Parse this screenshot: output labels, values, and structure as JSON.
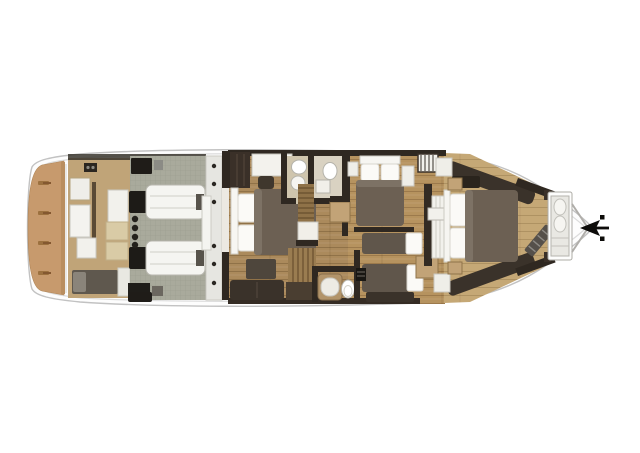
{
  "meta": {
    "plan_type": "yacht-lower-deck-floor-plan",
    "orientation": "bow-right",
    "engine_count": 2,
    "cleat_count": 4,
    "cabin_count": 4
  },
  "palette": {
    "background": "#ffffff",
    "hull_fill": "#fdfdfd",
    "hull_stroke": "#c2c2c2",
    "deck_line": "#dcdcdc",
    "teak": "#c79a6d",
    "teak_edge": "#b98e5f",
    "cleat": "#9c713f",
    "crew_floor": "#c0a478",
    "tile": "#a9aa9c",
    "tile_line": "#9a9b8d",
    "garage_strip": "#e6e6e1",
    "wood_vip": "#ab8a5c",
    "wood_mid": "#b6935f",
    "wood_master": "#c5a876",
    "plank_line": "#5a3c1e",
    "wall": "#2f2821",
    "wardrobe": "#3a3028",
    "white_furniture": "#f4f3ef",
    "furniture_stroke": "#b9b7b0",
    "duvet": "#6c6053",
    "duvet_twin": "#60564b",
    "pillow": "#fbfaf7",
    "sofa": "#3a322a",
    "bench": "#4e463c",
    "berth": "#5f584e",
    "berth_pillow": "#8a847a",
    "tan_cabinet": "#c2a377",
    "cream_seat": "#d9cba6",
    "engine_cap": "#1d1b17",
    "engine_body": "#f5f5f1",
    "black": "#1f1c18",
    "stairs_wood": "#8f7248",
    "stairs_line": "#5e4526",
    "shower_teak": "#b2946a",
    "bath_floor": "#cfc5ad",
    "bath_floor_light": "#d9d2c2",
    "anchor": "#0d0c0a",
    "bow_v": "#b0aeaa"
  },
  "areas": [
    {
      "id": "aft-swim-platform",
      "label": "aft teak swim platform"
    },
    {
      "id": "crew-quarters",
      "label": "crew quarters"
    },
    {
      "id": "engine-room",
      "label": "engine room with twin engines"
    },
    {
      "id": "vip-cabin",
      "label": "VIP double cabin"
    },
    {
      "id": "vip-bathroom",
      "label": "VIP bathroom"
    },
    {
      "id": "staircase",
      "label": "staircase"
    },
    {
      "id": "guest-bathroom",
      "label": "guest bathroom"
    },
    {
      "id": "guest-double-cabin",
      "label": "guest double cabin"
    },
    {
      "id": "guest-twin-cabin",
      "label": "guest twin cabin"
    },
    {
      "id": "master-cabin",
      "label": "master cabin"
    },
    {
      "id": "bow-bathroom",
      "label": "bow bathroom"
    },
    {
      "id": "anchor",
      "label": "anchor at bow tip"
    }
  ]
}
